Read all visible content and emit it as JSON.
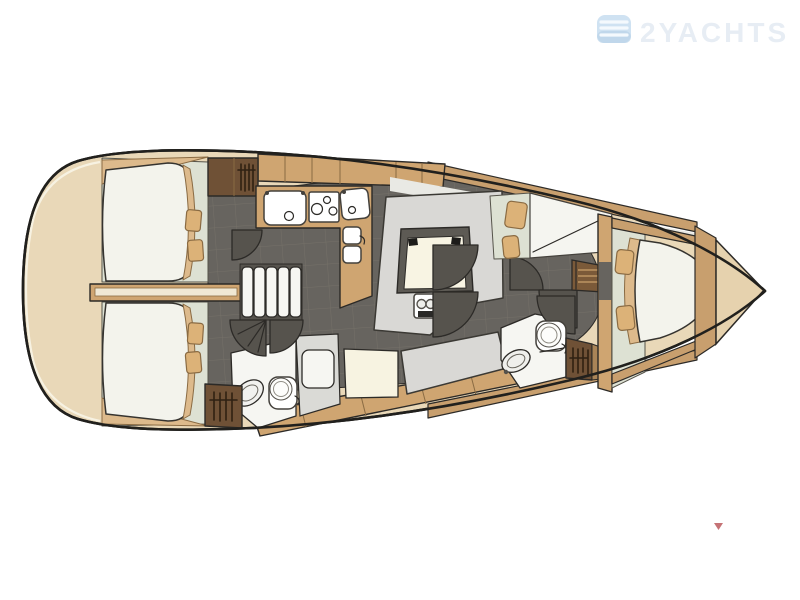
{
  "canvas": {
    "background": "#ffffff",
    "width_px": 800,
    "height_px": 600
  },
  "watermark": {
    "brand_text": "2YACHTS",
    "icon": "waves-badge-icon",
    "icon_color": "#cfe2f2",
    "text_color": "#e7edf4"
  },
  "corner_marker": {
    "shape": "small-red-triangle",
    "color": "#bb5a5e"
  },
  "palette": {
    "hull_deck": "#e9d8b8",
    "outline": "#21201d",
    "wood": "#cfa571",
    "dark_wood": "#6f5136",
    "floor": "#67645f",
    "floor_grid": "#757168",
    "soft_green": "#dde1d3",
    "mattress": "#f3f3ec",
    "blanket_tan": "#ddba8c",
    "pillow_tan": "#dcb278",
    "settee_gray": "#d9d8d5",
    "table_top": "#f8f4e3",
    "door_gray": "#56534d",
    "bow_locker": "#e6d2ae"
  },
  "plan": {
    "subject": "sailing-yacht-interior-deck-plan",
    "orientation": "bow-right-stern-left",
    "rooms": [
      "aft-cabin-port",
      "aft-cabin-starboard",
      "companionway",
      "galley",
      "salon",
      "aft-head-with-shower",
      "forward-head",
      "forward-cabin",
      "anchor-locker"
    ],
    "fixtures": [
      "double-berth-aft-port",
      "double-berth-aft-starboard",
      "companionway-steps",
      "galley-sink",
      "three-burner-stove",
      "second-sink",
      "top-loading-fridge",
      "hanging-lockers",
      "salon-u-settee",
      "salon-table",
      "bottle-holder",
      "straight-settee",
      "seat",
      "shower-tray",
      "washbasins",
      "marine-toilets",
      "door-swings",
      "v-berth-forward",
      "berth-pillows"
    ]
  }
}
